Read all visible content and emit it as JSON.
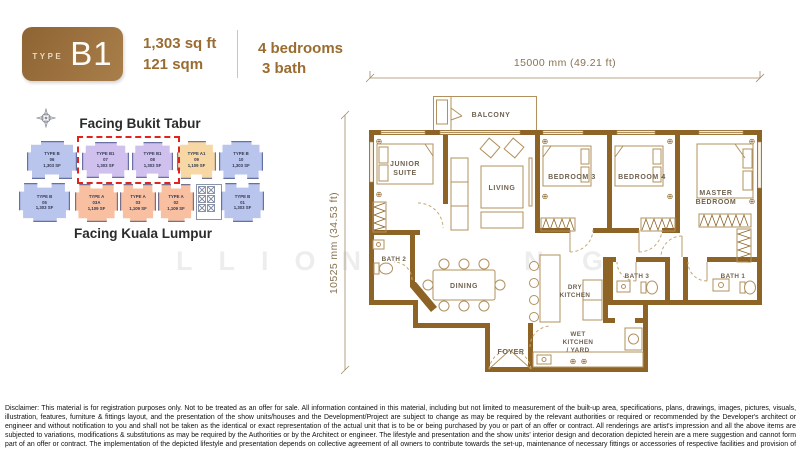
{
  "header": {
    "type_label": "TYPE",
    "type_value": "B1",
    "area_sqft": "1,303 sq ft",
    "area_sqm": "121 sqm",
    "bedrooms": "4 bedrooms",
    "bath": "3 bath"
  },
  "site_plan": {
    "facing_top": "Facing Bukit Tabur",
    "facing_bottom": "Facing Kuala Lumpur",
    "units_top": [
      {
        "type": "TYPE B",
        "no": "06",
        "area": "1,303 SF"
      },
      {
        "type": "TYPE B1",
        "no": "07",
        "area": "1,303 SF"
      },
      {
        "type": "TYPE B1",
        "no": "08",
        "area": "1,303 SF"
      },
      {
        "type": "TYPE A1",
        "no": "09",
        "area": "1,109 SF"
      },
      {
        "type": "TYPE B",
        "no": "10",
        "area": "1,303 SF"
      }
    ],
    "units_bottom": [
      {
        "type": "TYPE B",
        "no": "05",
        "area": "1,303 SF"
      },
      {
        "type": "TYPE A",
        "no": "03A",
        "area": "1,109 SF"
      },
      {
        "type": "TYPE A",
        "no": "03",
        "area": "1,109 SF"
      },
      {
        "type": "TYPE A",
        "no": "02",
        "area": "1,109 SF"
      },
      {
        "type": "TYPE B",
        "no": "01",
        "area": "1,303 SF"
      }
    ]
  },
  "floor_plan": {
    "dim_width": "15000 mm (49.21 ft)",
    "dim_height": "10525 mm (34.53 ft)",
    "rooms": {
      "balcony": "BALCONY",
      "junior_suite_1": "JUNIOR",
      "junior_suite_2": "SUITE",
      "living": "LIVING",
      "bedroom3": "BEDROOM 3",
      "bedroom4": "BEDROOM 4",
      "master_1": "MASTER",
      "master_2": "BEDROOM",
      "bath2": "BATH 2",
      "dining": "DINING",
      "dry_1": "DRY",
      "dry_2": "KITCHEN",
      "bath3": "BATH 3",
      "bath1": "BATH 1",
      "foyer": "FOYER",
      "wet_1": "WET",
      "wet_2": "KITCHEN",
      "wet_3": "/ YARD"
    }
  },
  "watermark": {
    "part1": "LLION",
    "part2": "N",
    "part3": "G"
  },
  "disclaimer": "Disclaimer: This material is for registration purposes only. Not to be treated as an offer for sale. All information contained in this material, including but not limited to measurement of the built-up area, specifications, plans, drawings, images, pictures, visuals, illustration, features, furniture & fittings layout, and the presentation of the show units/houses and the Development/Project are subject to change as may be required by the relevant authorities or required or recommended by the Developer's architect or engineer and without notification to you and shall not be taken as the identical or exact representation of the actual unit that is to be or being purchased by you or part of an offer or contract. All renderings are artist's impression and all the above items are subjected to variations, modifications & substitutions as may be required by the Authorities or by the Architect or engineer. The lifestyle and presentation and the show units' interior design and decoration depicted herein are a mere suggestion and cannot form part of an offer or contract. The implementation of the depicted lifestyle and presentation depends on collective agreement of all owners to contribute towards the set-up, maintenance of necessary fittings or accessories of respective facilities and provision of the relevant lifestyle services.",
  "colors": {
    "accent_brown": "#9a6c31",
    "wall_brown": "#8d6426",
    "highlight_red": "#e2231d",
    "unit_blue": "#b9c5ec",
    "unit_purple": "#cfc0ee",
    "unit_tan": "#f7d7a4",
    "unit_salmon": "#f8c0a0"
  }
}
